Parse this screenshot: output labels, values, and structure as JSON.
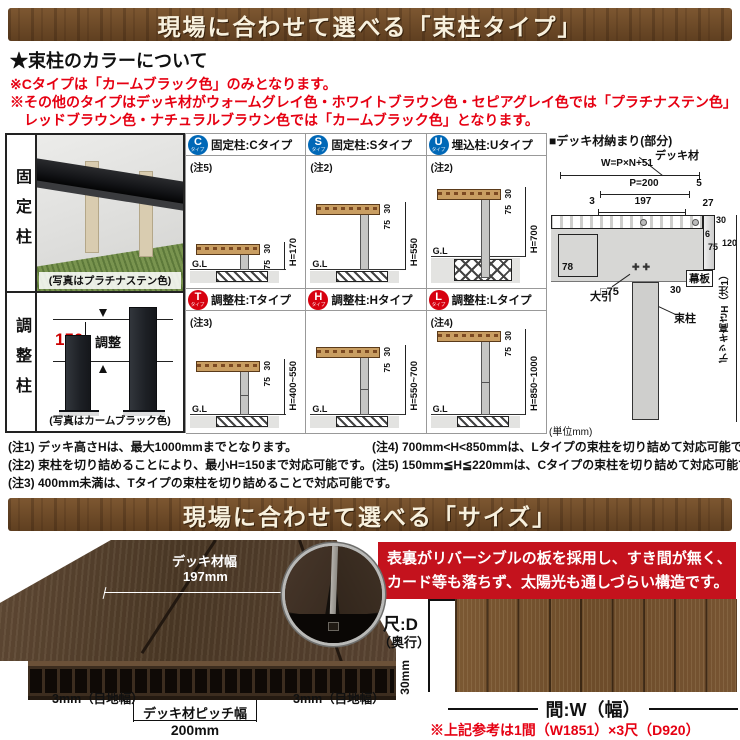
{
  "colors": {
    "banner_brown": "#6f4b28",
    "accent_red": "#e60012",
    "badge_blue": "#0068b7",
    "badge_red": "#d7000f",
    "feature_box_red": "#c4121d"
  },
  "banner1": {
    "title": "現場に合わせて選べる「束柱タイプ」"
  },
  "color_info": {
    "heading": "★束柱のカラーについて",
    "line1": "※Cタイプは「カームブラック色」のみとなります。",
    "line2": "※その他のタイプはデッキ材がウォームグレイ色・ホワイトブラウン色・セピアグレイ色では「プラチナステン色」",
    "line3": "レッドブラウン色・ナチュラルブラウン色では「カームブラック色」となります。"
  },
  "left_panel": {
    "fixed_label": "固定柱",
    "fixed_caption": "(写真はプラチナステン色)",
    "adjust_label": "調整柱",
    "adjust_caption": "(写真はカームブラック色)",
    "adjust_dim": "150",
    "adjust_text": "調整"
  },
  "grid": {
    "gl": "G.L",
    "cells": [
      {
        "badge": "C",
        "badge_sub": "タイプ",
        "title": "固定柱:Cタイプ",
        "note": "(注5)",
        "dim30": "30",
        "dim75": "75",
        "h": "H=170"
      },
      {
        "badge": "S",
        "badge_sub": "タイプ",
        "title": "固定柱:Sタイプ",
        "note": "(注2)",
        "dim30": "30",
        "dim75": "75",
        "h": "H=550"
      },
      {
        "badge": "U",
        "badge_sub": "タイプ",
        "title": "埋込柱:Uタイプ",
        "note": "(注2)",
        "dim30": "30",
        "dim75": "75",
        "h": "H=700"
      },
      {
        "badge": "T",
        "badge_sub": "タイプ",
        "title": "調整柱:Tタイプ",
        "note": "(注3)",
        "dim30": "30",
        "dim75": "75",
        "h": "H=400~550"
      },
      {
        "badge": "H",
        "badge_sub": "タイプ",
        "title": "調整柱:Hタイプ",
        "note": "",
        "dim30": "30",
        "dim75": "75",
        "h": "H=550~700"
      },
      {
        "badge": "L",
        "badge_sub": "タイプ",
        "title": "調整柱:Lタイプ",
        "note": "(注4)",
        "dim30": "30",
        "dim75": "75",
        "h": "H=850~1000"
      }
    ]
  },
  "detail": {
    "title": "■デッキ材納まり(部分)",
    "deck_label": "デッキ材",
    "w_formula": "W=P×N+51",
    "p_dim": "P=200",
    "dim5": "5",
    "dim3": "3",
    "dim197": "197",
    "dim27": "27",
    "dim6": "6",
    "dim30_top": "30",
    "dim75_right": "75",
    "dim120": "120",
    "dim78": "78",
    "dim30_bottom": "30",
    "dim9": "9",
    "obiki_label": "大引",
    "post_size": "□75",
    "tsuka_label": "束柱",
    "makuita_label": "幕板",
    "height_label": "デッキ高さH（注1）",
    "unit_note": "(単位mm)"
  },
  "notes": {
    "n1": "(注1) デッキ高さHは、最大1000mmまでとなります。",
    "n2": "(注2) 束柱を切り詰めることにより、最小H=150まで対応可能です。",
    "n3": "(注3) 400mm未満は、Tタイプの束柱を切り詰めることで対応可能です。",
    "n4": "(注4) 700mm<H<850mmは、Lタイプの束柱を切り詰めて対応可能です。",
    "n5": "(注5) 150mm≦H≦220mmは、Cタイプの束柱を切り詰めて対応可能です。"
  },
  "banner2": {
    "title": "現場に合わせて選べる「サイズ」"
  },
  "size_section": {
    "deck_width_label": "デッキ材幅",
    "deck_width_value": "197mm",
    "joint_label_left": "3mm（目地幅）",
    "joint_label_right": "3mm（目地幅）",
    "pitch_label": "デッキ材ピッチ幅",
    "pitch_value": "200mm",
    "thickness": "30mm",
    "feature_line1": "表裏がリバーシブルの板を採用し、すき間が無く、",
    "feature_line2": "カード等も落ちず、太陽光も通しづらい構造です。",
    "depth_label": "尺:D",
    "depth_sub": "（奥行）",
    "width_label": "間:W（幅）",
    "ref_note": "※上記参考は1間（W1851）×3尺（D920）"
  }
}
